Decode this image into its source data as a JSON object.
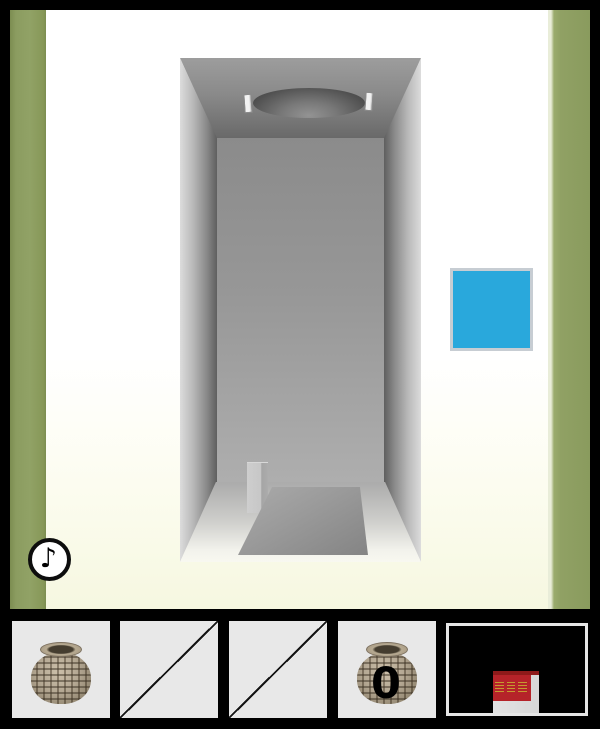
{
  "game": {
    "scene": {
      "wall_strip_color": "#8fa063",
      "background_top": "#ffffff",
      "background_bottom": "#f6f7e0",
      "corridor": {
        "description": "gray one-point-perspective corridor",
        "ceiling_hatch": "round recessed hole with two brackets",
        "floor_pit": "rectangular pit in floor",
        "pedestal": "small gray box beside pit"
      },
      "blue_button": {
        "color": "#29a8dc",
        "border_color": "#c7cdd3"
      },
      "music_button": {
        "glyph": "♪"
      }
    },
    "inventory": {
      "slot_background": "#e8e8e8",
      "slots": [
        {
          "state": "filled",
          "item": "woven-basket"
        },
        {
          "state": "empty"
        },
        {
          "state": "empty"
        },
        {
          "state": "filled",
          "item": "woven-basket",
          "count": "0"
        }
      ],
      "thumbnail": {
        "description": "dark scene with red sign on light pillar",
        "sign_color": "#b52329",
        "sign_cap_color": "#8e1a1a",
        "marks_color": "#c59a30"
      }
    }
  }
}
